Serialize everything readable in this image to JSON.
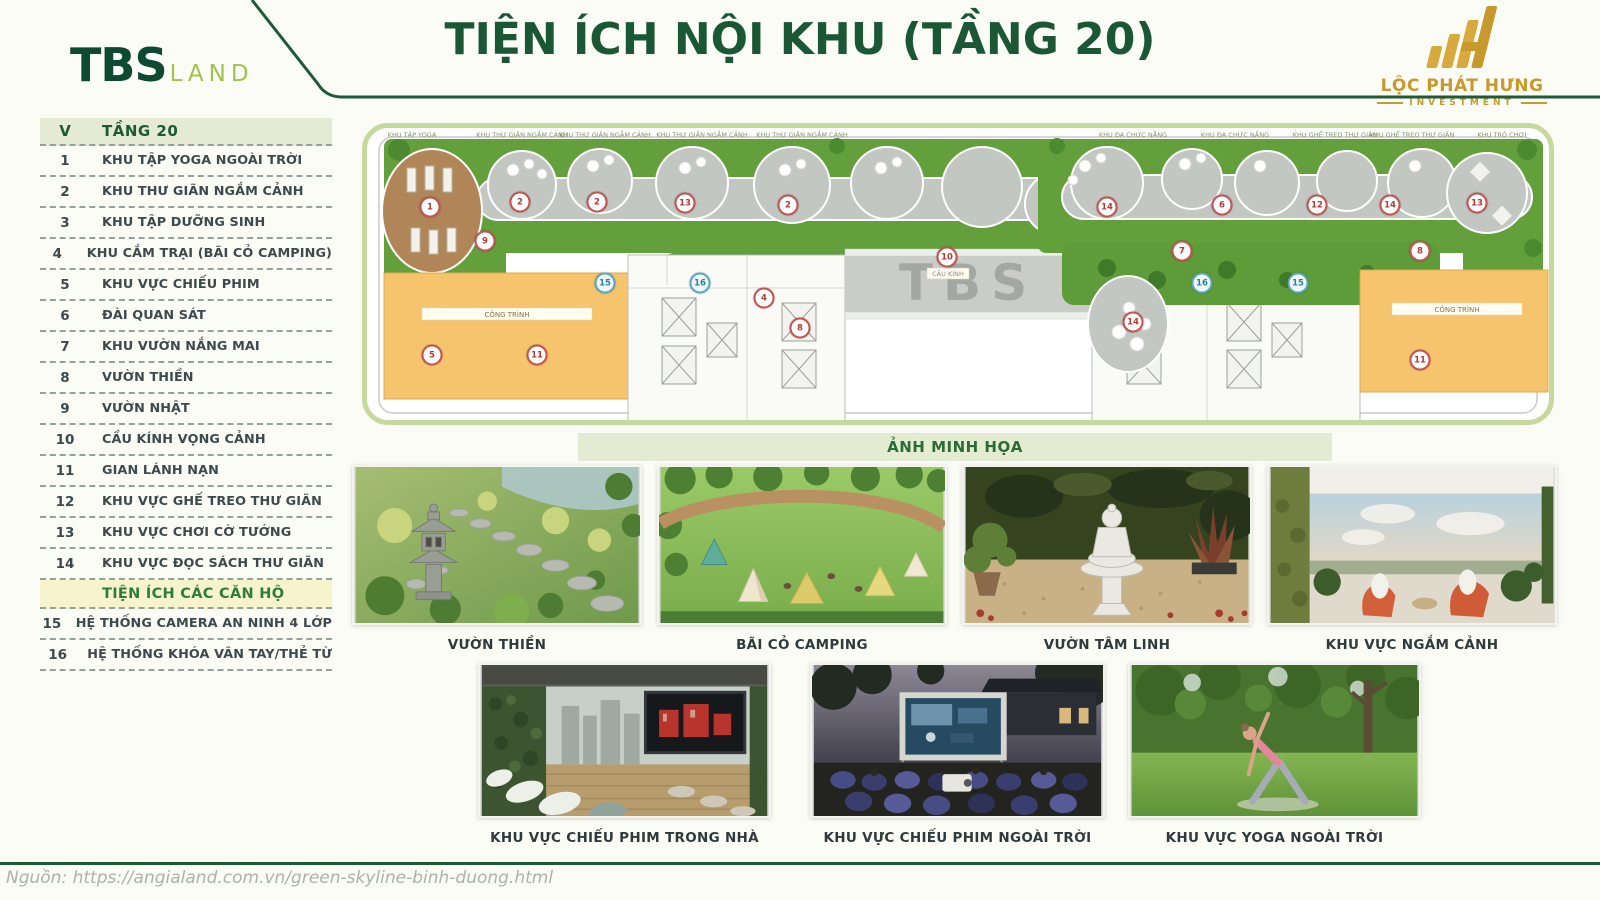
{
  "header": {
    "title": "TIỆN ÍCH NỘI KHU (TẦNG 20)",
    "brand_tbs": {
      "main": "TBS",
      "sub": "LAND"
    },
    "brand_lph": {
      "name": "LỘC PHÁT HƯNG",
      "sub": "INVESTMENT"
    }
  },
  "legend": {
    "header": {
      "col1": "V",
      "col2": "TẦNG 20"
    },
    "rows": [
      {
        "type": "item",
        "num": "1",
        "label": "KHU TẬP YOGA NGOÀI TRỜI"
      },
      {
        "type": "item",
        "num": "2",
        "label": "KHU THƯ GIÃN NGẮM CẢNH"
      },
      {
        "type": "item",
        "num": "3",
        "label": "KHU TẬP DƯỠNG SINH"
      },
      {
        "type": "item",
        "num": "4",
        "label": "KHU CẮM TRẠI (BÃI CỎ CAMPING)"
      },
      {
        "type": "item",
        "num": "5",
        "label": "KHU VỰC CHIẾU PHIM"
      },
      {
        "type": "item",
        "num": "6",
        "label": "ĐÀI QUAN SÁT"
      },
      {
        "type": "item",
        "num": "7",
        "label": "KHU VƯỜN NẮNG MAI"
      },
      {
        "type": "item",
        "num": "8",
        "label": "VƯỜN THIỀN"
      },
      {
        "type": "item",
        "num": "9",
        "label": "VƯỜN NHẬT"
      },
      {
        "type": "item",
        "num": "10",
        "label": "CẦU KÍNH VỌNG CẢNH"
      },
      {
        "type": "item",
        "num": "11",
        "label": "GIAN LÁNH NẠN"
      },
      {
        "type": "item",
        "num": "12",
        "label": "KHU VỰC GHẾ TREO THƯ GIÃN"
      },
      {
        "type": "item",
        "num": "13",
        "label": "KHU VỰC CHƠI CỜ TƯỚNG"
      },
      {
        "type": "item",
        "num": "14",
        "label": "KHU VỰC ĐỌC SÁCH THƯ GIÃN"
      },
      {
        "type": "section",
        "label": "TIỆN ÍCH CÁC CĂN HỘ"
      },
      {
        "type": "item",
        "num": "15",
        "label": "HỆ THỐNG CAMERA AN NINH 4 LỚP"
      },
      {
        "type": "item",
        "num": "16",
        "label": "HỆ THỐNG KHÓA VÂN TAY/THẺ TỪ"
      }
    ]
  },
  "plan": {
    "bridge_text": "TBS",
    "bridge_label": "CẦU KÍNH",
    "room_label_left": "CÔNG TRÌNH",
    "room_label_right": "CÔNG TRÌNH",
    "top_labels": [
      {
        "x": 45,
        "text": "KHU TẬP YOGA"
      },
      {
        "x": 155,
        "text": "KHU THƯ GIÃN NGẮM CẢNH"
      },
      {
        "x": 238,
        "text": "KHU THƯ GIÃN NGẮM CẢNH"
      },
      {
        "x": 335,
        "text": "KHU THƯ GIÃN NGẮM CẢNH"
      },
      {
        "x": 435,
        "text": "KHU THƯ GIÃN NGẮM CẢNH"
      },
      {
        "x": 766,
        "text": "KHU ĐA CHỨC NĂNG"
      },
      {
        "x": 868,
        "text": "KHU ĐA CHỨC NĂNG"
      },
      {
        "x": 968,
        "text": "KHU GHẾ TREO THƯ GIÃN"
      },
      {
        "x": 1045,
        "text": "KHU GHẾ TREO THƯ GIÃN"
      },
      {
        "x": 1135,
        "text": "KHU TRÒ CHƠI"
      }
    ],
    "markers": [
      {
        "n": "1",
        "x": 63,
        "y": 79,
        "c": "red"
      },
      {
        "n": "2",
        "x": 153,
        "y": 74,
        "c": "red"
      },
      {
        "n": "2",
        "x": 230,
        "y": 74,
        "c": "red"
      },
      {
        "n": "13",
        "x": 318,
        "y": 75,
        "c": "red"
      },
      {
        "n": "2",
        "x": 421,
        "y": 77,
        "c": "red"
      },
      {
        "n": "9",
        "x": 118,
        "y": 113,
        "c": "red"
      },
      {
        "n": "15",
        "x": 238,
        "y": 155,
        "c": "blue"
      },
      {
        "n": "16",
        "x": 333,
        "y": 155,
        "c": "blue"
      },
      {
        "n": "4",
        "x": 397,
        "y": 170,
        "c": "red"
      },
      {
        "n": "8",
        "x": 433,
        "y": 200,
        "c": "red"
      },
      {
        "n": "5",
        "x": 65,
        "y": 227,
        "c": "red"
      },
      {
        "n": "11",
        "x": 170,
        "y": 227,
        "c": "red"
      },
      {
        "n": "10",
        "x": 580,
        "y": 129,
        "c": "red"
      },
      {
        "n": "14",
        "x": 740,
        "y": 79,
        "c": "red"
      },
      {
        "n": "6",
        "x": 855,
        "y": 77,
        "c": "red"
      },
      {
        "n": "12",
        "x": 950,
        "y": 77,
        "c": "red"
      },
      {
        "n": "14",
        "x": 1023,
        "y": 77,
        "c": "red"
      },
      {
        "n": "13",
        "x": 1110,
        "y": 75,
        "c": "red"
      },
      {
        "n": "7",
        "x": 815,
        "y": 123,
        "c": "red"
      },
      {
        "n": "8",
        "x": 1053,
        "y": 123,
        "c": "red"
      },
      {
        "n": "16",
        "x": 835,
        "y": 155,
        "c": "blue"
      },
      {
        "n": "15",
        "x": 931,
        "y": 155,
        "c": "blue"
      },
      {
        "n": "14",
        "x": 766,
        "y": 194,
        "c": "red"
      },
      {
        "n": "11",
        "x": 1053,
        "y": 232,
        "c": "red"
      }
    ]
  },
  "gallery_band": "ẢNH MINH HỌA",
  "gallery": {
    "captions": [
      "VƯỜN THIỀN",
      "BÃI CỎ CAMPING",
      "VƯỜN TÂM LINH",
      "KHU VỰC NGẮM CẢNH",
      "KHU VỰC CHIẾU PHIM TRONG NHÀ",
      "KHU VỰC CHIẾU PHIM NGOÀI TRỜI",
      "KHU VỰC YOGA NGOÀI TRỜI"
    ]
  },
  "source": "Nguồn: https://angialand.com.vn/green-skyline-binh-duong.html",
  "colors": {
    "dark_green": "#1a5734",
    "light_green_border": "#c5d89e",
    "legend_header_bg": "#e4ead3",
    "section_bg": "#f6f3cd",
    "gold": "#c8992d",
    "plan_green": "#63a03c",
    "plan_path_gray": "#c3c7c2",
    "plan_orange": "#f6c46d"
  }
}
